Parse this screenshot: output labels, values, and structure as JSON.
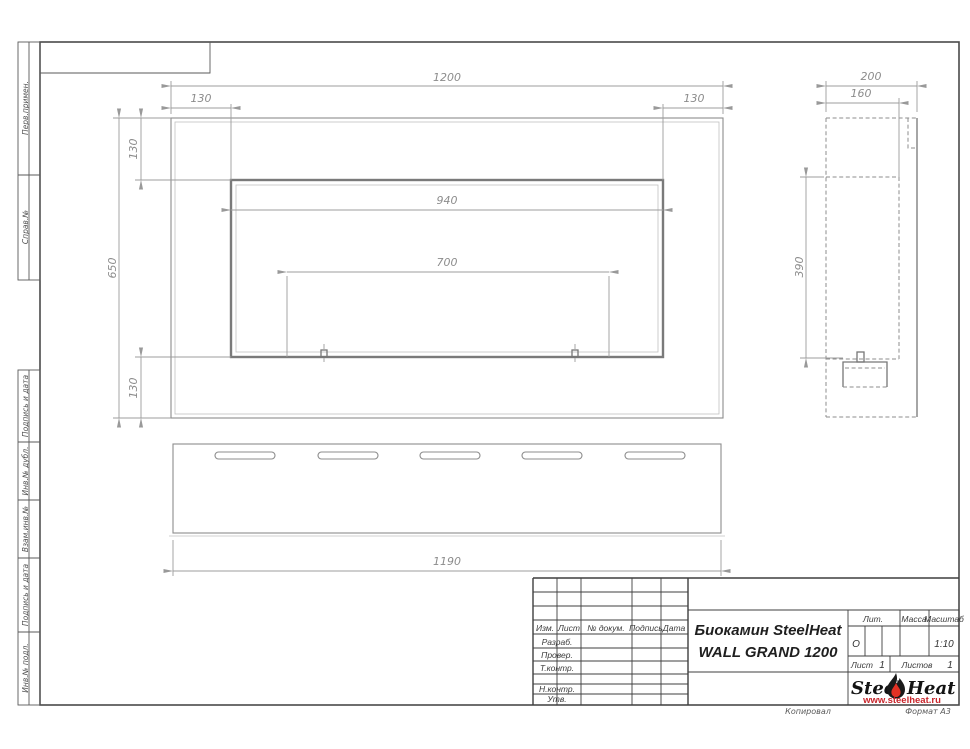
{
  "frame_labels": {
    "top_sections": [
      "Перв.примен.",
      "Справ.№"
    ],
    "bottom_sections": [
      "Подпись и дата",
      "Инв.№ дубл.",
      "Взам.инв.№",
      "Подпись и дата",
      "Инв.№ подл."
    ]
  },
  "dims": {
    "front_width": "1200",
    "front_left_offset": "130",
    "front_right_offset": "130",
    "front_top_offset": "130",
    "front_bottom_offset": "130",
    "front_height": "650",
    "opening_width": "940",
    "burner_width": "700",
    "side_depth": "200",
    "side_inner_depth": "160",
    "side_opening_height": "390",
    "bottom_length": "1190"
  },
  "title_block": {
    "headers": {
      "izm": "Изм.",
      "list": "Лист",
      "doc": "№ докум.",
      "sign": "Подпись",
      "date": "Дата"
    },
    "rows": [
      "Разраб.",
      "Провер.",
      "Т.контр.",
      "Н.контр.",
      "Утв."
    ],
    "title_line1": "Биокамин SteelHeat",
    "title_line2": "WALL GRAND 1200",
    "lit_header": "Лит.",
    "lit_value": "О",
    "mass_header": "Масса",
    "scale_header": "Масштаб",
    "scale_value": "1:10",
    "sheet_label": "Лист",
    "sheet_value": "1",
    "sheets_label": "Листов",
    "sheets_value": "1"
  },
  "logo": {
    "steel": "Steel",
    "heat": "Heat",
    "url": "www.steelheat.ru",
    "flame_red": "#e23124",
    "flame_black": "#1a1a1a"
  },
  "footer": {
    "copied_label": "Копировал",
    "format_label": "Формат А3"
  }
}
